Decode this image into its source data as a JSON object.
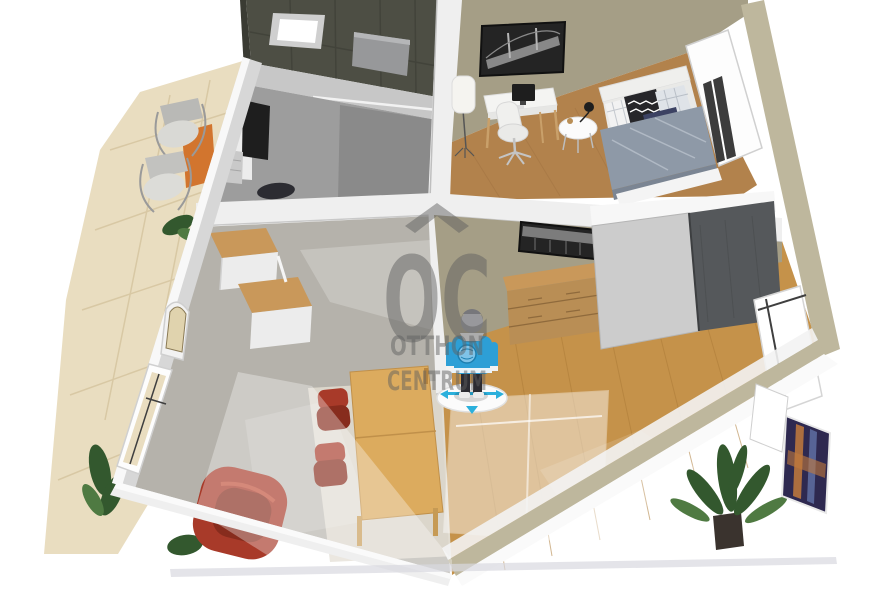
{
  "watermark": {
    "logo": "OC",
    "line1": "OTTHON",
    "line2": "CENTRUM"
  },
  "avatar": {
    "type": "person-figure-camera-control",
    "control": "move-disc-with-arrows"
  },
  "scene": {
    "view": "3d-cutaway-floorplan",
    "rooms": [
      {
        "name": "terrace",
        "objects": [
          "outdoor-chair",
          "outdoor-chair",
          "orange-outdoor-rug",
          "plants",
          "stone-paving"
        ]
      },
      {
        "name": "bathroom",
        "objects": [
          "dark-wall-tiles",
          "skylight-window",
          "shower-panel"
        ]
      },
      {
        "name": "kitchen",
        "objects": [
          "white-cabinet",
          "tall-dark-cabinet",
          "counter-unit",
          "dark-chair"
        ]
      },
      {
        "name": "bedroom-office",
        "objects": [
          "bridge-wall-art",
          "floor-lamp",
          "desk",
          "desktop-computer",
          "office-chair",
          "side-table",
          "table-lamp",
          "single-bed",
          "pillows",
          "window"
        ]
      },
      {
        "name": "hallway",
        "objects": [
          "storage-shelf",
          "storage-shelf",
          "arched-door"
        ]
      },
      {
        "name": "bedroom",
        "objects": [
          "city-wall-art",
          "chest-of-drawers",
          "sliding-door-wardrobe",
          "ghost-bed",
          "ghost-rug-outline",
          "potted-plant",
          "abstract-wall-art",
          "window"
        ]
      },
      {
        "name": "living-dining",
        "objects": [
          "dining-table",
          "red-dining-chair",
          "red-dining-chair",
          "red-armchair",
          "light-rug",
          "window"
        ]
      }
    ]
  },
  "colors": {
    "bg": "#ffffff",
    "terrace_stone": "#e9ddc0",
    "terrace_grout": "#d6c5a0",
    "terrace_rug": "#d2752e",
    "wall_light": "#efefef",
    "wall_mid": "#d7d7d7",
    "wall_shadow": "#bdbdbd",
    "bath_tile": "#4d4e44",
    "bath_tile_line": "#41423a",
    "kitchen_wall": "#9d9d9d",
    "khaki_wall": "#a59e86",
    "khaki_wall_light": "#beb79d",
    "wood_floor_office": "#b2824c",
    "wood_plank_office": "#a07140",
    "wood_floor_bedroom": "#c5924a",
    "wood_plank_bedroom": "#ad7c38",
    "tile_floor": "#b5b2ab",
    "light_rug": "#ded9cd",
    "furniture_white": "#f4f4f2",
    "shelf_wood": "#c9985a",
    "dresser_wood": "#b98e55",
    "table_wood": "#dcab5e",
    "red_upholstery": "#a83a29",
    "red_upholstery_dark": "#872c1d",
    "wardrobe_light": "#cccccc",
    "wardrobe_dark": "#55585b",
    "picture_dark": "#242424",
    "picture_gray": "#9a9a9a",
    "art_navy": "#2e2950",
    "art_orange": "#c27a3c",
    "art_blue": "#6173a8",
    "avatar_blue": "#2d9fd6",
    "avatar_dark": "#2c2c32",
    "avatar_head": "#98989c",
    "arrow_cyan": "#2bb0dc",
    "plant_green": "#33582e",
    "plant_green_light": "#4f7a42",
    "black_unit": "#1e1e1e",
    "glass_dark": "#3c3c3c",
    "duvet_gray": "#8e99a7",
    "duvet_light": "#b9c1cc",
    "pillow_navy": "#3c4263",
    "pillow_dark": "#26262a",
    "pillow_white": "#f2f2f2",
    "pillow_gray": "#dfe3e8",
    "bed_white": "#efefed",
    "watermark_gray": "#5f5f5f"
  }
}
